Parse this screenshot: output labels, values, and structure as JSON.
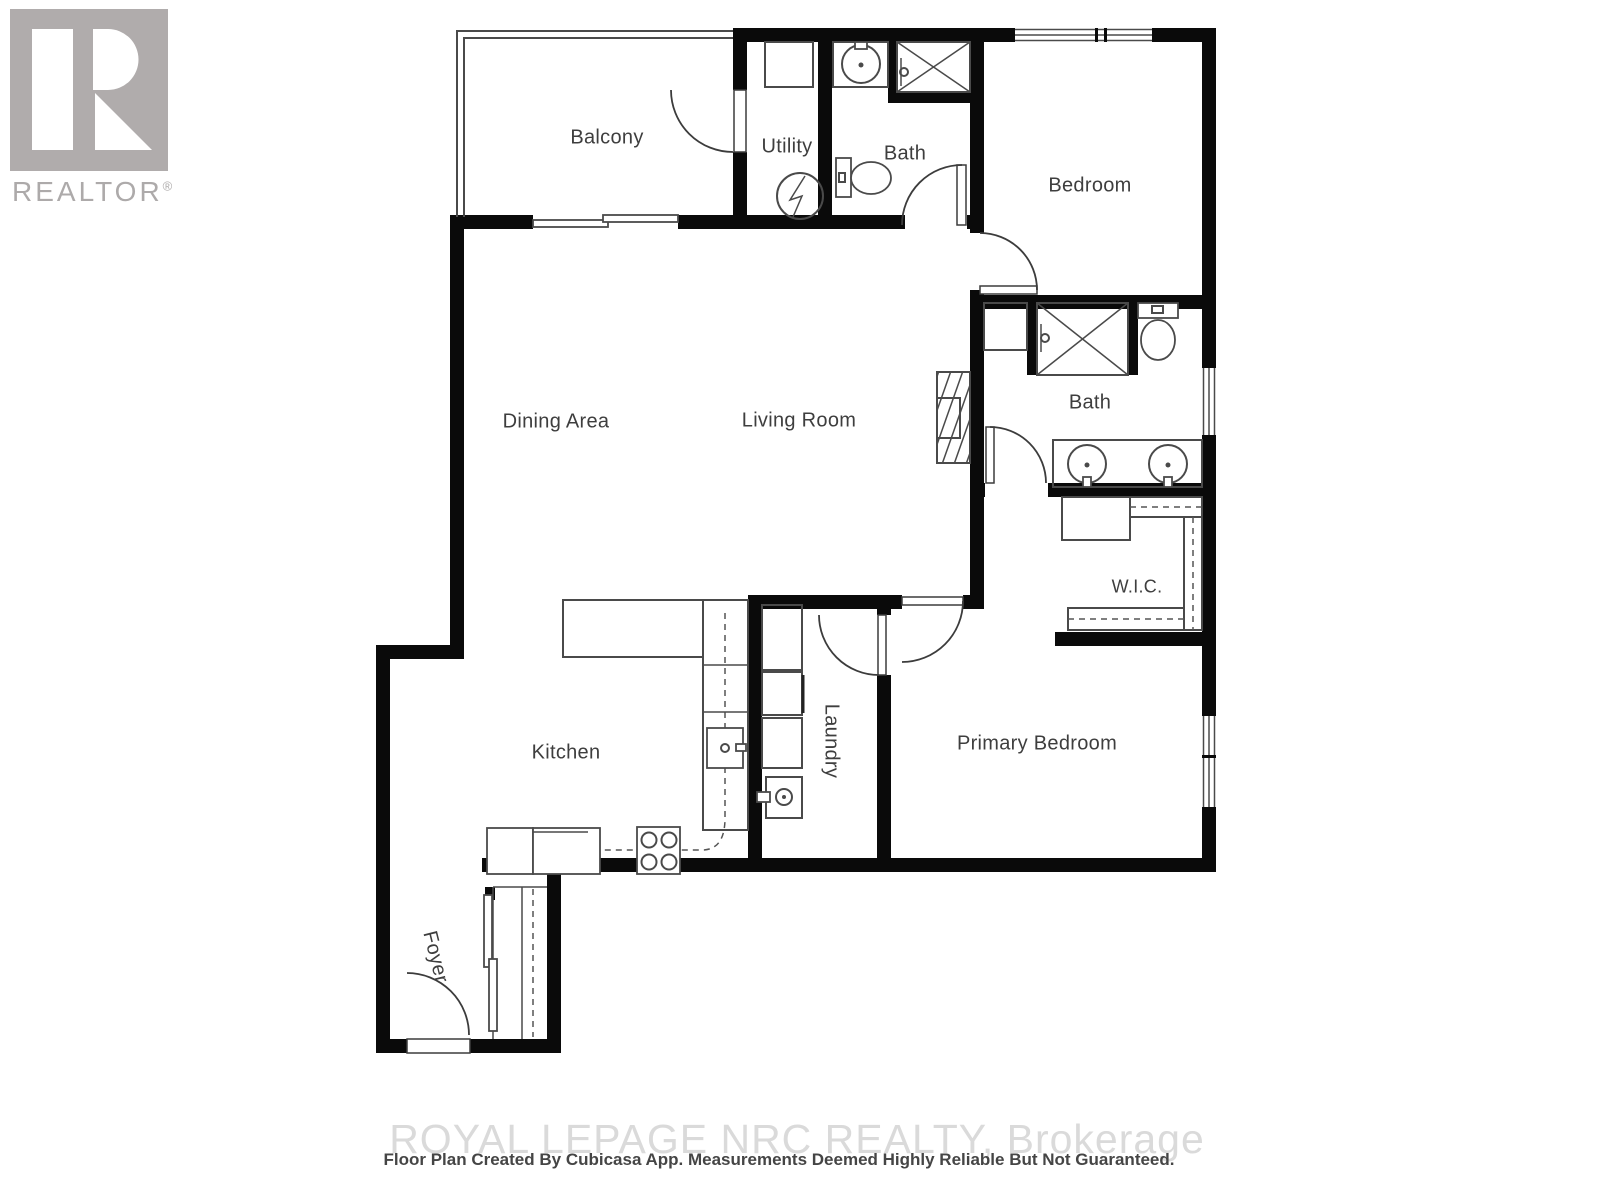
{
  "logo": {
    "brand": "REALTOR",
    "registered_mark": "®"
  },
  "rooms": {
    "balcony": {
      "label": "Balcony"
    },
    "utility": {
      "label": "Utility"
    },
    "bath_top": {
      "label": "Bath"
    },
    "bedroom": {
      "label": "Bedroom"
    },
    "dining": {
      "label": "Dining Area"
    },
    "living": {
      "label": "Living Room"
    },
    "bath_ensuite": {
      "label": "Bath"
    },
    "wic": {
      "label": "W.I.C."
    },
    "kitchen": {
      "label": "Kitchen"
    },
    "laundry": {
      "label": "Laundry"
    },
    "primary": {
      "label": "Primary Bedroom"
    },
    "foyer": {
      "label": "Foyer"
    }
  },
  "footer": {
    "watermark": "ROYAL LEPAGE NRC REALTY, Brokerage",
    "disclaimer": "Floor Plan Created By Cubicasa App. Measurements Deemed Highly Reliable But Not Guaranteed."
  },
  "colors": {
    "wall": "#0a0a0a",
    "line": "#4a4a4a",
    "label": "#3e3e3e",
    "logo-gray": "#b0acac",
    "logo-text": "#adaaaa",
    "wm": "#dadada",
    "disc": "#454545"
  }
}
